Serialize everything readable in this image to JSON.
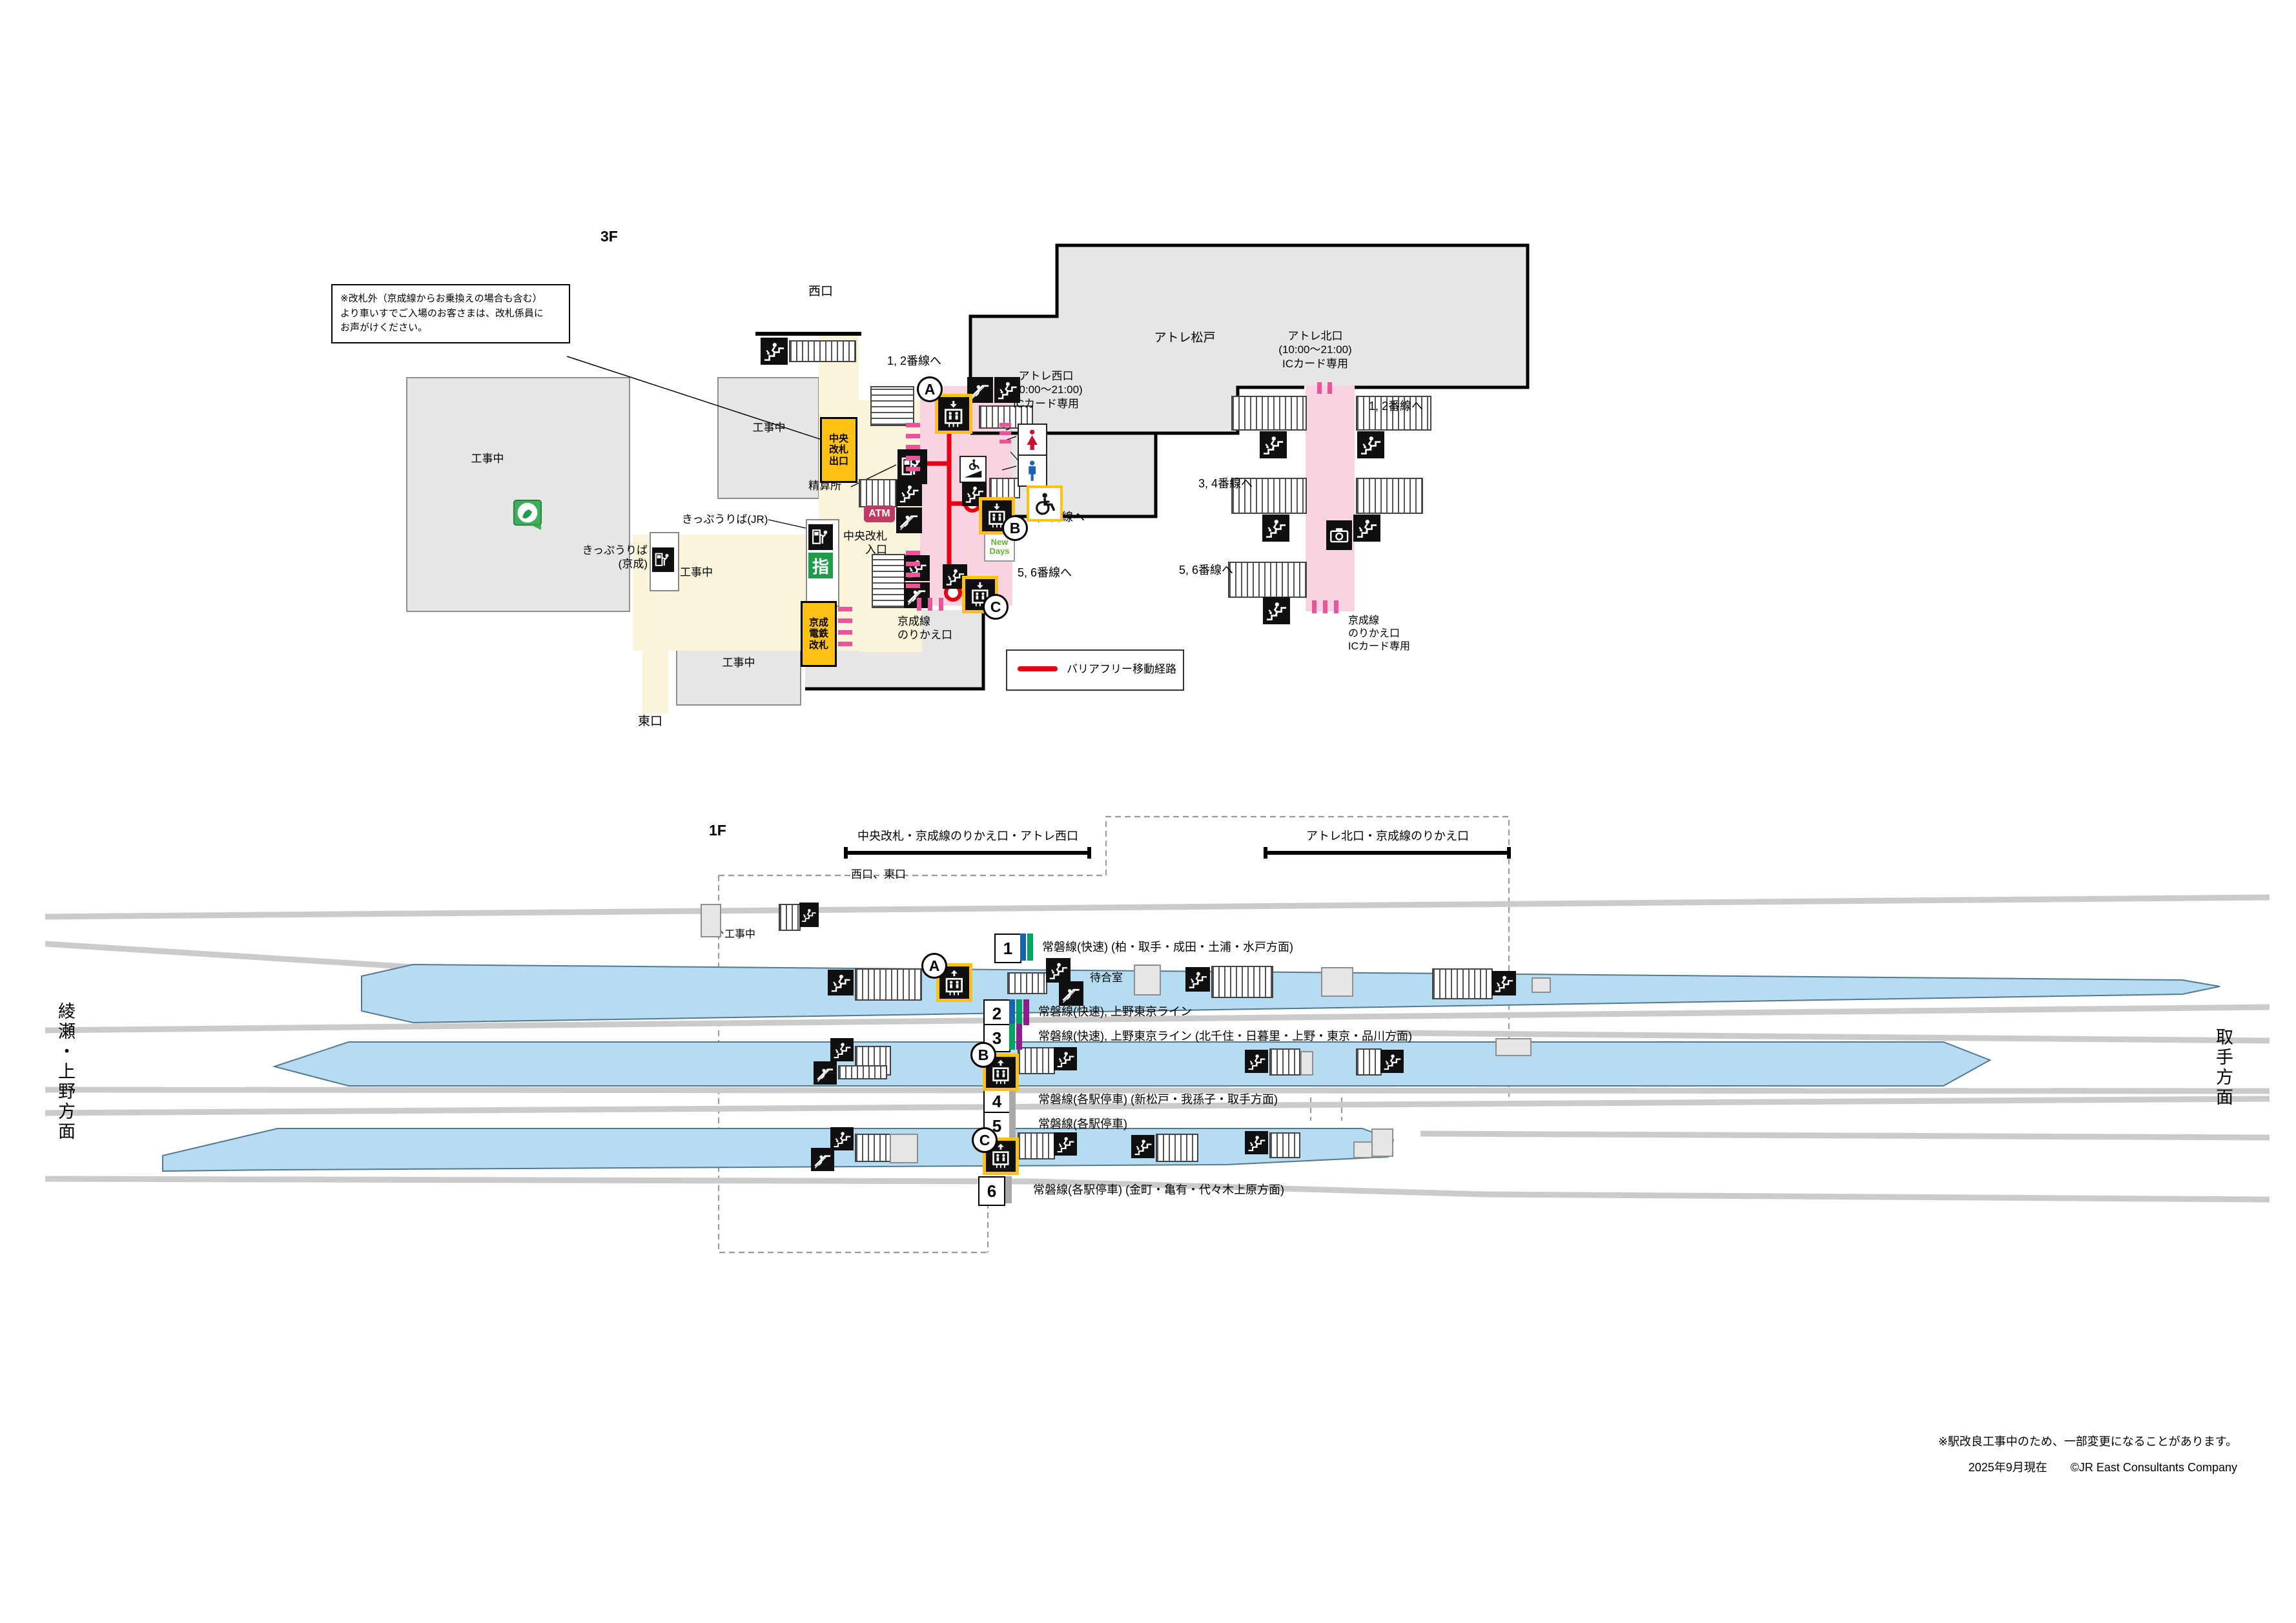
{
  "meta": {
    "floor3": "3F",
    "floor1": "1F"
  },
  "f3": {
    "note": "※改札外（京成線からお乗換えの場合も含む）\nより車いすでご入場のお客さまは、改札係員に\nお声がけください。",
    "west_exit": "西口",
    "east_exit": "東口",
    "under_construction": "工事中",
    "chuo_gate_exit": "中央\n改札\n出口",
    "fare_adjustment": "精算所",
    "atm": "ATM",
    "chuo_gate_entrance": "中央改札\n入口",
    "ticket_office_jr": "きっぷうりば(JR)",
    "ticket_office_keisei": "きっぷうりば\n(京成)",
    "reserved_seat_machine": "指",
    "keisei_gate": "京成\n電鉄\n改札",
    "keisei_transfer": "京成線\nのりかえ口",
    "keisei_transfer_ic": "京成線\nのりかえ口\nICカード専用",
    "atre_west": "アトレ西口\n(10:00〜21:00)\nICカード専用",
    "atre_matsudo": "アトレ松戸",
    "atre_north": "アトレ北口\n(10:00〜21:00)\nICカード専用",
    "to_tracks_12": "1, 2番線へ",
    "to_tracks_34": "3, 4番線へ",
    "to_tracks_56": "5, 6番線へ",
    "newdays": "New\nDays",
    "legend_barrier_free": "バリアフリー移動経路",
    "elevator_a": "A",
    "elevator_b": "B",
    "elevator_c": "C"
  },
  "f1": {
    "gate_guide_center": "中央改札・京成線のりかえ口・アトレ西口",
    "gate_guide_north": "アトレ北口・京成線のりかえ口",
    "west_east_exit": "西口、東口",
    "waiting_room": "待合室",
    "direction_left": "綾瀬・上野方面",
    "direction_right": "取手方面",
    "platforms": [
      {
        "num": "1",
        "colors": [
          "#1D62AD",
          "#00A263"
        ],
        "label": "常磐線(快速)  (柏・取手・成田・土浦・水戸方面)"
      },
      {
        "num": "2",
        "colors": [
          "#1D62AD",
          "#00A263",
          "#8E1E8E"
        ],
        "label": "常磐線(快速), 上野東京ライン"
      },
      {
        "num": "3",
        "colors": [
          "#00A263",
          "#8E1E8E"
        ],
        "label": "常磐線(快速), 上野東京ライン (北千住・日暮里・上野・東京・品川方面)"
      },
      {
        "num": "4",
        "colors": [
          "#A9A9A9"
        ],
        "label": "常磐線(各駅停車) (新松戸・我孫子・取手方面)"
      },
      {
        "num": "5",
        "colors": [
          "#A9A9A9"
        ],
        "label": "常磐線(各駅停車)"
      },
      {
        "num": "6",
        "colors": [
          "#A9A9A9"
        ],
        "label": "常磐線(各駅停車) (金町・亀有・代々木上原方面)"
      }
    ]
  },
  "footer": {
    "note": "※駅改良工事中のため、一部変更になることがあります。",
    "credit": "2025年9月現在　　©JR East Consultants Company"
  },
  "colors": {
    "route_red": "#E60012",
    "concourse_pink": "#F8D3E2",
    "gate_pink": "#E8559A",
    "paid_yellow": "#FFC114",
    "platform_blue": "#B5DCF0",
    "atm_magenta": "#BE3A62",
    "reserved_green": "#1F9C49"
  }
}
